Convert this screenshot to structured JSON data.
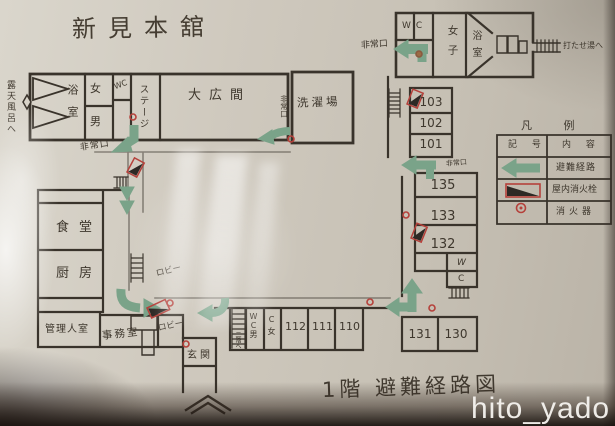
{
  "photo": {
    "watermark": "hito_yado"
  },
  "plan": {
    "title": "新見本舘",
    "caption": "1階 避難経路図",
    "labels": {
      "to_rotenburo": "露天風呂へ",
      "to_utaseyu": "打たせ湯へ",
      "bath": "浴室",
      "women": "女",
      "men": "男",
      "wc_bath": "WC",
      "stage": "ステージ",
      "large_hall": "大広間",
      "laundry": "洗濯場",
      "exit_bath": "非常口",
      "exit_laundry": "非常口",
      "exit_north": "非常口",
      "exit_east": "非常口",
      "wc_north": "WC",
      "women_north": "女子",
      "bath_north": "浴室",
      "dining": "食堂",
      "kitchen": "厨房",
      "manager": "管理人室",
      "office": "事務室",
      "lobby_a": "ロビー",
      "lobby_b": "ロビー",
      "entrance": "玄関",
      "stairs_up": "二階へ",
      "wc_mid_w": "W",
      "wc_mid_c": "C",
      "wc_south_men": "WC男",
      "wc_south_women": "C女"
    },
    "room_numbers": {
      "east_upper": [
        "103",
        "102",
        "101"
      ],
      "east_mid": [
        "135",
        "133",
        "132"
      ],
      "east_lower": [
        "131",
        "130"
      ],
      "south": [
        "112",
        "111",
        "110"
      ]
    },
    "legend": {
      "title": "凡 例",
      "col_symbol": "記 号",
      "col_content": "内 容",
      "rows": [
        {
          "icon": "evacuation-route-arrow",
          "label": "避難経路"
        },
        {
          "icon": "indoor-fire-hydrant",
          "label": "屋内消火栓"
        },
        {
          "icon": "fire-extinguisher",
          "label": "消火器"
        }
      ]
    },
    "colors": {
      "paper": "#cdc7bb",
      "ink": "#39332b",
      "route_green": "#7aa389",
      "alarm_red": "#b5413b"
    }
  }
}
